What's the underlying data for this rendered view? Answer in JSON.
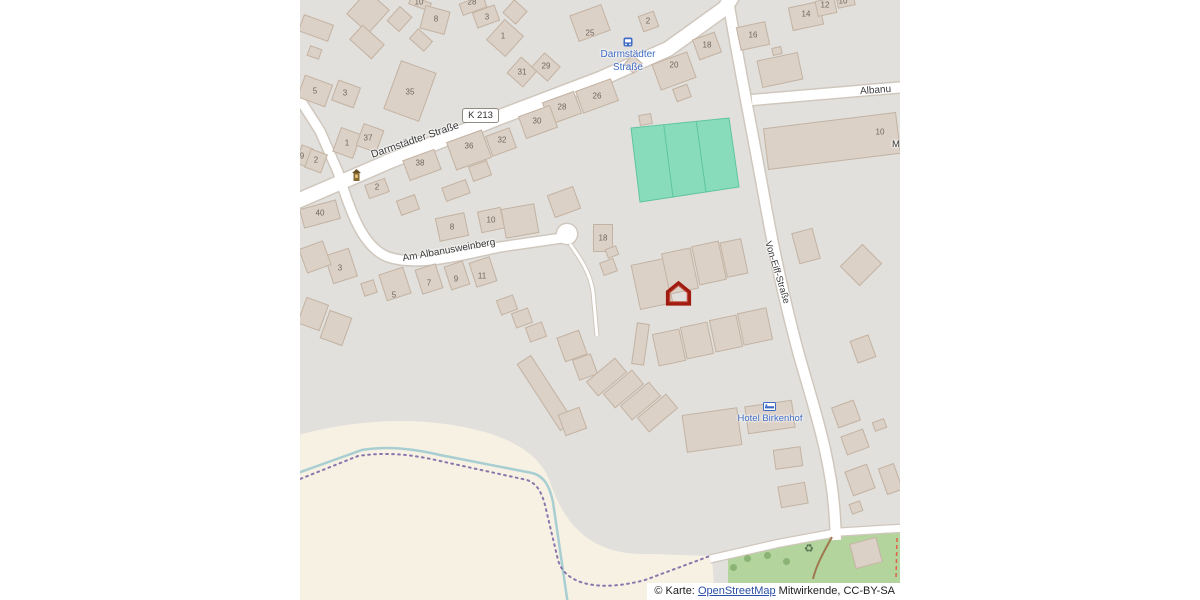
{
  "colors": {
    "bg_outside": "#ffffff",
    "map_bg": "#e2e0dc",
    "farmland": "#f6f1e3",
    "pitch": "#88dcbc",
    "pitch_line": "#5ec4a0",
    "grass": "#b3d49c",
    "tree": "#84ad6e",
    "stream": "#a8ced2",
    "boundary": "#8a75ad",
    "road": "#ffffff",
    "road_casing": "#cfc7bd",
    "building": "#dcd1c7",
    "building_stroke": "#c3b3a3",
    "track": "#a0784f",
    "red_dash": "#e0604c",
    "number": "#70675e",
    "street_label": "#3a3a3a",
    "transit_blue": "#3e6bc4",
    "marker_red": "#a01b10",
    "attr_link": "#2a4ea5"
  },
  "labels": {
    "street_darmstadter": "Darmstädter Straße",
    "street_am_albanusweinberg": "Am Albanusweinberg",
    "street_von_eiff": "Von-Eiff-Straße",
    "street_albanus_partial": "Albanu",
    "building_partial_m": "M",
    "route_ref": "K 213",
    "bus_stop_line1": "Darmstädter",
    "bus_stop_line2": "Straße",
    "hotel_name": "Hotel Birkenhof",
    "recycling_symbol": "♻"
  },
  "attribution": {
    "prefix": "© Karte: ",
    "link_text": "OpenStreetMap",
    "suffix": " Mitwirkende, CC-BY-SA"
  },
  "housenumbers": [
    [
      119,
      2,
      "10"
    ],
    [
      136,
      19,
      "8"
    ],
    [
      172,
      2,
      "28"
    ],
    [
      187,
      17,
      "3"
    ],
    [
      203,
      36,
      "1"
    ],
    [
      290,
      33,
      "25"
    ],
    [
      348,
      21,
      "2"
    ],
    [
      222,
      72,
      "31"
    ],
    [
      246,
      66,
      "29"
    ],
    [
      15,
      91,
      "5"
    ],
    [
      45,
      93,
      "3"
    ],
    [
      110,
      92,
      "35"
    ],
    [
      297,
      96,
      "26"
    ],
    [
      262,
      107,
      "28"
    ],
    [
      237,
      121,
      "30"
    ],
    [
      202,
      140,
      "32"
    ],
    [
      169,
      146,
      "36"
    ],
    [
      120,
      163,
      "38"
    ],
    [
      68,
      138,
      "37"
    ],
    [
      47,
      143,
      "1"
    ],
    [
      16,
      160,
      "2"
    ],
    [
      2,
      156,
      "9"
    ],
    [
      77,
      187,
      "2"
    ],
    [
      20,
      213,
      "40"
    ],
    [
      374,
      65,
      "20"
    ],
    [
      407,
      45,
      "18"
    ],
    [
      453,
      35,
      "16"
    ],
    [
      506,
      14,
      "14"
    ],
    [
      525,
      5,
      "12"
    ],
    [
      543,
      1,
      "10"
    ],
    [
      580,
      132,
      "10"
    ],
    [
      152,
      227,
      "8"
    ],
    [
      191,
      220,
      "10"
    ],
    [
      303,
      238,
      "18"
    ],
    [
      40,
      268,
      "3"
    ],
    [
      94,
      295,
      "5"
    ],
    [
      129,
      283,
      "7"
    ],
    [
      156,
      279,
      "9"
    ],
    [
      182,
      276,
      "11"
    ]
  ],
  "buildings": [
    [
      68,
      12,
      30,
      32,
      42
    ],
    [
      99,
      19,
      17,
      20,
      42
    ],
    [
      120,
      3,
      22,
      9,
      20
    ],
    [
      135,
      20,
      26,
      24,
      15
    ],
    [
      121,
      40,
      20,
      14,
      42
    ],
    [
      16,
      28,
      32,
      18,
      20
    ],
    [
      14,
      52,
      13,
      11,
      20
    ],
    [
      67,
      42,
      30,
      20,
      42
    ],
    [
      173,
      5,
      26,
      13,
      -20
    ],
    [
      186,
      16,
      24,
      17,
      -20
    ],
    [
      205,
      38,
      26,
      28,
      42
    ],
    [
      215,
      12,
      18,
      18,
      42
    ],
    [
      15,
      91,
      30,
      24,
      20
    ],
    [
      46,
      94,
      24,
      22,
      20
    ],
    [
      110,
      91,
      38,
      52,
      20
    ],
    [
      47,
      143,
      22,
      26,
      20
    ],
    [
      70,
      138,
      22,
      24,
      20
    ],
    [
      4,
      156,
      13,
      20,
      20
    ],
    [
      16,
      161,
      18,
      20,
      20
    ],
    [
      77,
      188,
      22,
      15,
      -20
    ],
    [
      20,
      214,
      38,
      20,
      -15
    ],
    [
      290,
      23,
      34,
      28,
      -20
    ],
    [
      348,
      21,
      17,
      17,
      -20
    ],
    [
      222,
      72,
      22,
      22,
      42
    ],
    [
      246,
      67,
      22,
      20,
      42
    ],
    [
      297,
      96,
      38,
      24,
      -20
    ],
    [
      262,
      108,
      34,
      24,
      -20
    ],
    [
      238,
      122,
      34,
      24,
      -20
    ],
    [
      201,
      142,
      26,
      22,
      -20
    ],
    [
      169,
      150,
      38,
      30,
      -20
    ],
    [
      180,
      171,
      20,
      16,
      -20
    ],
    [
      122,
      165,
      34,
      22,
      -20
    ],
    [
      156,
      190,
      26,
      15,
      -20
    ],
    [
      374,
      71,
      38,
      28,
      -20
    ],
    [
      382,
      93,
      16,
      14,
      -20
    ],
    [
      407,
      46,
      24,
      22,
      -20
    ],
    [
      333,
      64,
      14,
      14,
      42
    ],
    [
      345,
      119,
      13,
      11,
      -10
    ],
    [
      453,
      36,
      30,
      24,
      -12
    ],
    [
      506,
      16,
      32,
      24,
      -12
    ],
    [
      526,
      7,
      20,
      16,
      -12
    ],
    [
      546,
      2,
      18,
      9,
      -12
    ],
    [
      480,
      70,
      42,
      28,
      -12
    ],
    [
      477,
      51,
      10,
      8,
      -12
    ],
    [
      532,
      141,
      134,
      42,
      -7
    ],
    [
      506,
      246,
      22,
      32,
      -15
    ],
    [
      561,
      265,
      28,
      32,
      45
    ],
    [
      563,
      349,
      20,
      24,
      -20
    ],
    [
      546,
      414,
      24,
      22,
      -20
    ],
    [
      579,
      425,
      13,
      10,
      -20
    ],
    [
      555,
      442,
      24,
      20,
      -20
    ],
    [
      560,
      480,
      24,
      26,
      -20
    ],
    [
      590,
      479,
      17,
      28,
      -20
    ],
    [
      556,
      507,
      12,
      11,
      -20
    ],
    [
      566,
      553,
      28,
      26,
      -15
    ],
    [
      152,
      227,
      30,
      24,
      -12
    ],
    [
      191,
      220,
      24,
      22,
      -12
    ],
    [
      220,
      221,
      34,
      30,
      -10
    ],
    [
      264,
      202,
      28,
      24,
      -20
    ],
    [
      108,
      205,
      20,
      16,
      -20
    ],
    [
      303,
      238,
      20,
      28,
      0
    ],
    [
      312,
      252,
      12,
      10,
      -20
    ],
    [
      308,
      267,
      15,
      14,
      -20
    ],
    [
      41,
      266,
      26,
      30,
      -18
    ],
    [
      15,
      257,
      26,
      26,
      -20
    ],
    [
      95,
      284,
      26,
      28,
      -18
    ],
    [
      69,
      288,
      14,
      14,
      -18
    ],
    [
      129,
      279,
      22,
      26,
      -18
    ],
    [
      157,
      275,
      20,
      25,
      -18
    ],
    [
      183,
      272,
      22,
      26,
      -18
    ],
    [
      13,
      314,
      24,
      28,
      20
    ],
    [
      36,
      328,
      24,
      30,
      20
    ],
    [
      207,
      305,
      18,
      16,
      -20
    ],
    [
      222,
      318,
      18,
      16,
      -20
    ],
    [
      236,
      332,
      18,
      16,
      -20
    ],
    [
      245,
      393,
      17,
      80,
      -33
    ],
    [
      272,
      346,
      24,
      26,
      -20
    ],
    [
      285,
      367,
      20,
      22,
      -20
    ],
    [
      272,
      421,
      23,
      23,
      -20
    ],
    [
      352,
      284,
      34,
      46,
      -12
    ],
    [
      380,
      271,
      30,
      42,
      -12
    ],
    [
      409,
      263,
      28,
      40,
      -12
    ],
    [
      434,
      258,
      22,
      36,
      -12
    ],
    [
      369,
      347,
      28,
      33,
      -12
    ],
    [
      397,
      340,
      28,
      33,
      -12
    ],
    [
      426,
      333,
      28,
      33,
      -12
    ],
    [
      455,
      326,
      30,
      33,
      -12
    ],
    [
      340,
      344,
      13,
      42,
      8
    ],
    [
      306,
      377,
      19,
      38,
      50
    ],
    [
      323,
      389,
      19,
      38,
      50
    ],
    [
      340,
      401,
      19,
      38,
      50
    ],
    [
      357,
      413,
      19,
      38,
      50
    ],
    [
      412,
      430,
      56,
      38,
      -8
    ],
    [
      470,
      417,
      48,
      28,
      -8
    ],
    [
      488,
      458,
      28,
      20,
      -8
    ],
    [
      493,
      495,
      28,
      22,
      -10
    ]
  ],
  "trees": [
    [
      447,
      558
    ],
    [
      467,
      555
    ],
    [
      486,
      561
    ],
    [
      433,
      567
    ]
  ]
}
